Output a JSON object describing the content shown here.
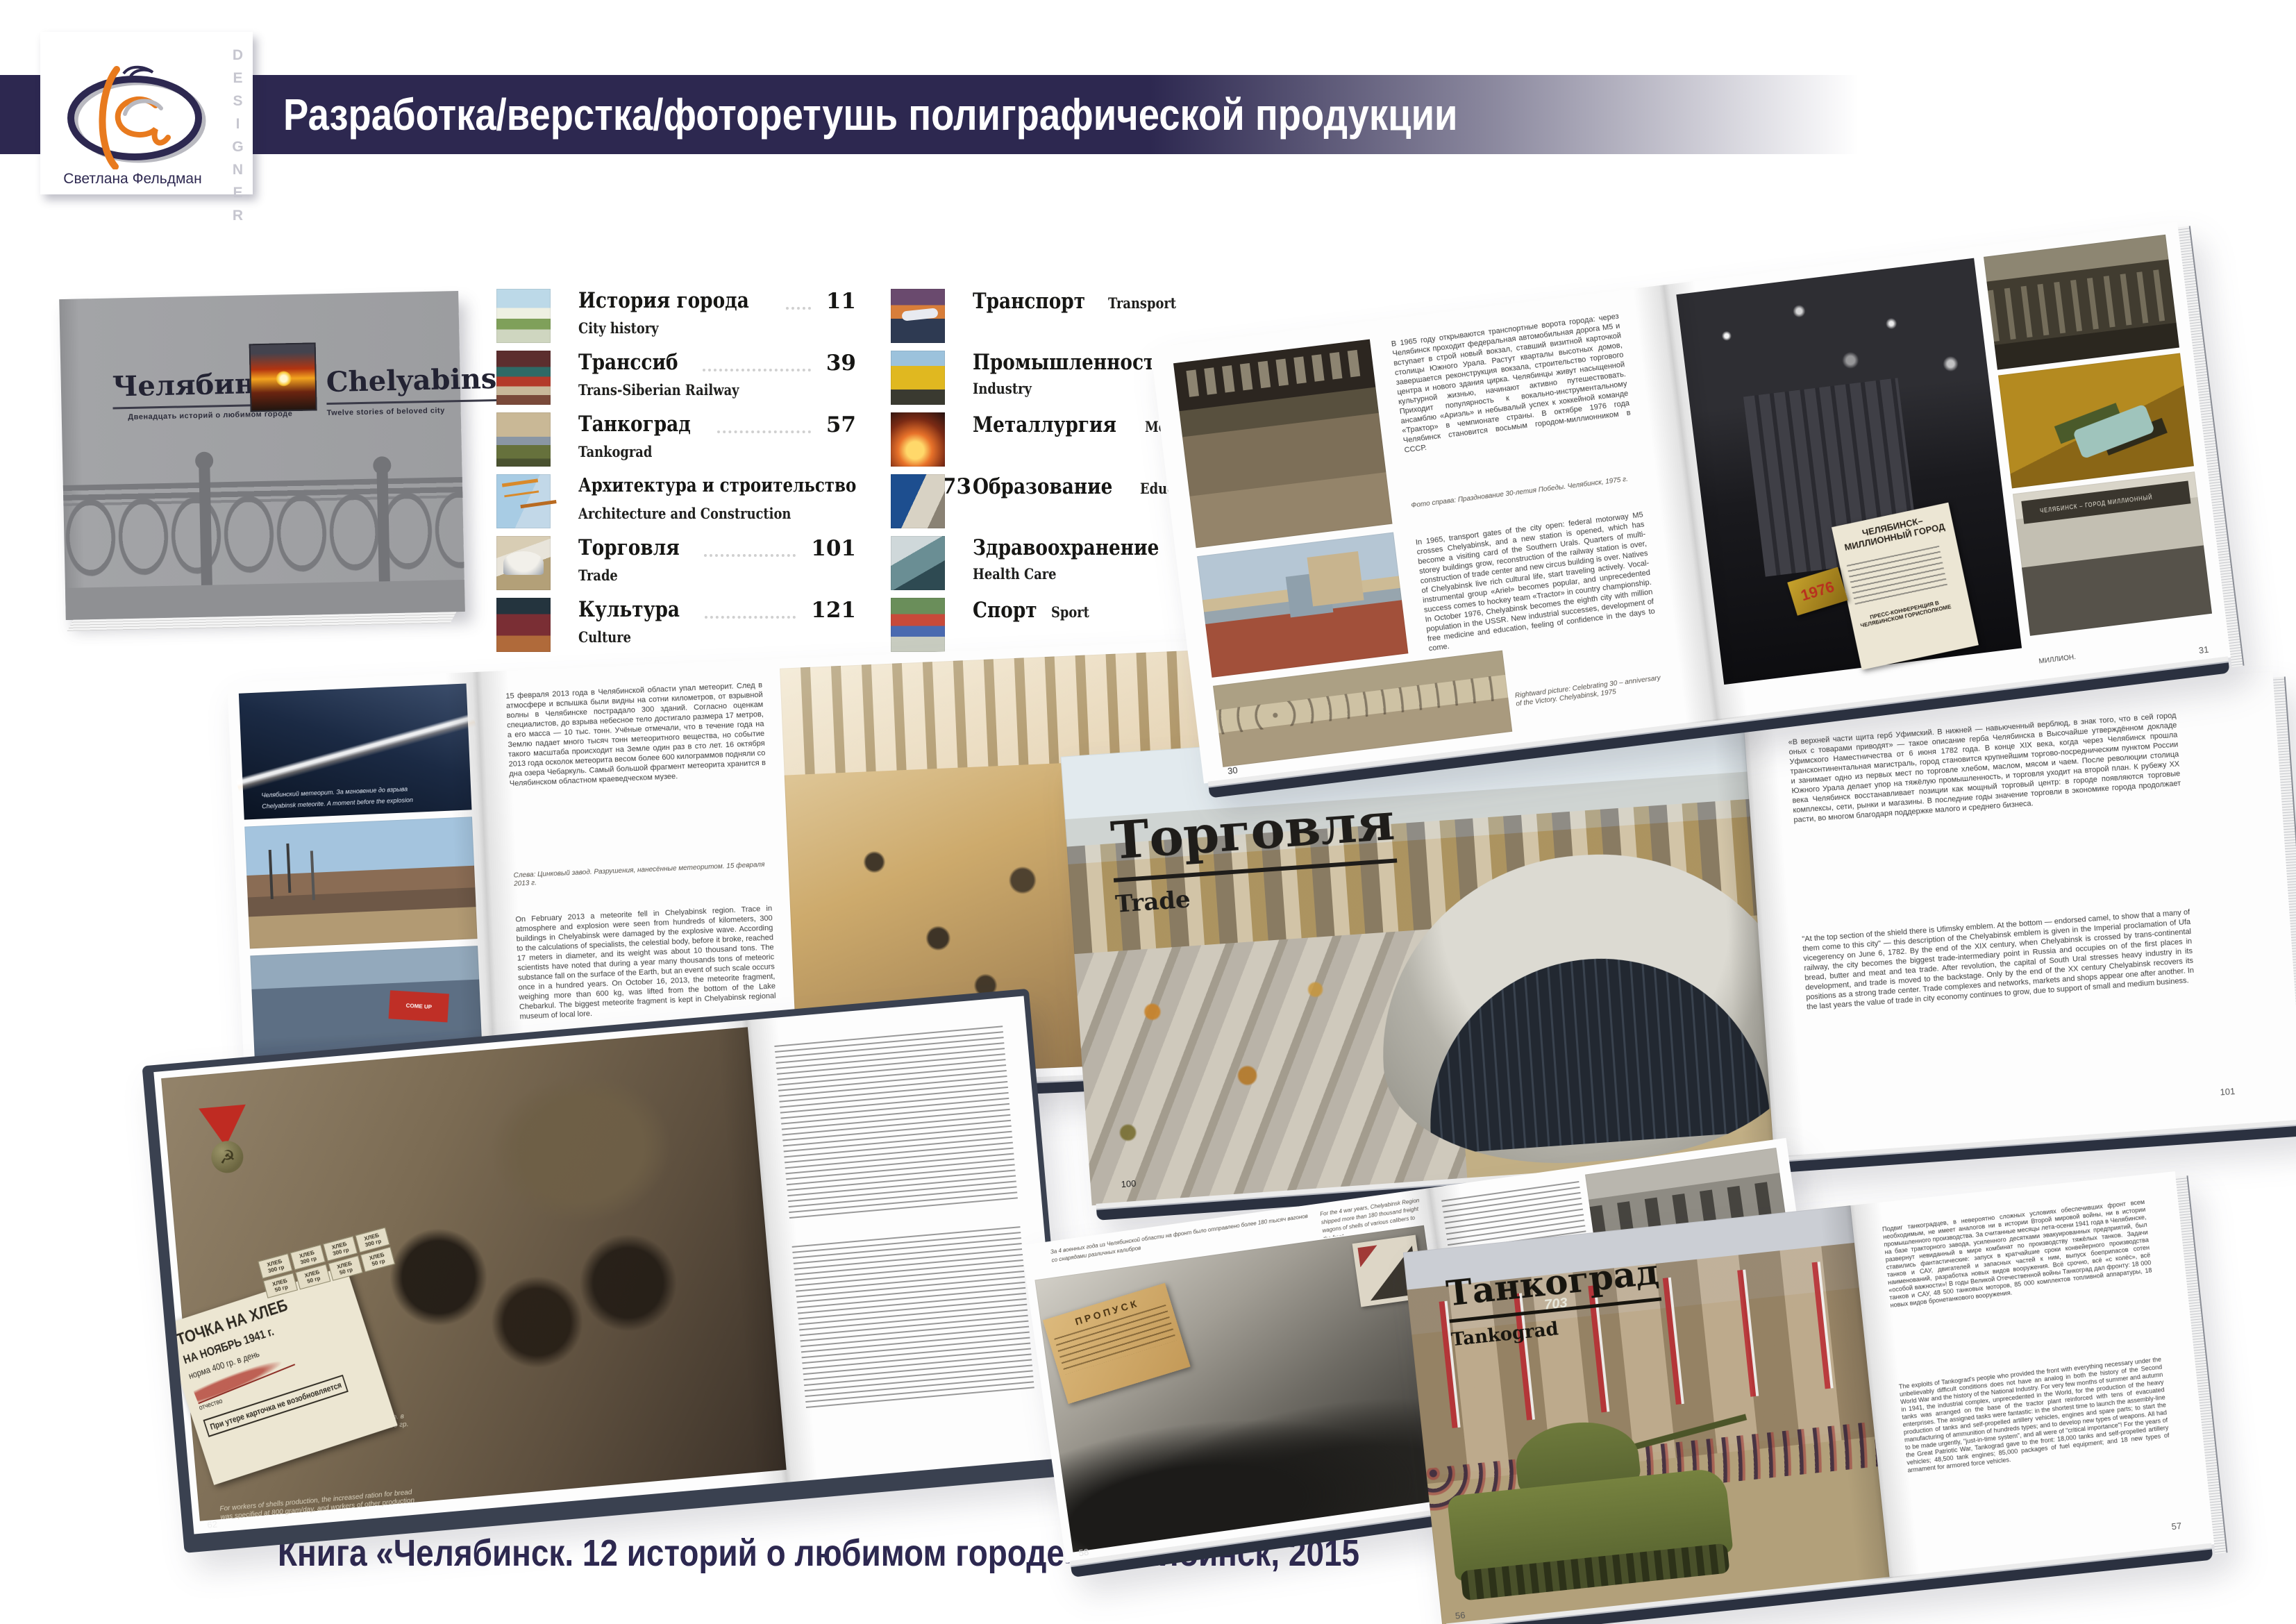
{
  "colors": {
    "navy": "#2d2850",
    "orange": "#e87a1e",
    "cover_gray": "#9c9da0"
  },
  "logo": {
    "designer": "DESIGNER",
    "name": "Светлана Фельдман"
  },
  "header": {
    "title": "Разработка/верстка/фоторетушь полиграфической продукции"
  },
  "footer": {
    "caption": "Книга «Челябинск. 12 историй о любимом городе». Челябинск, 2015"
  },
  "cover": {
    "title_ru": "Челябинск",
    "subtitle_ru": "Двенадцать историй о любимом городе",
    "title_en": "Chelyabinsk",
    "subtitle_en": "Twelve stories of beloved city"
  },
  "toc": {
    "left": [
      {
        "title": "История города",
        "subtitle": "City history",
        "page": "11"
      },
      {
        "title": "Транссиб",
        "subtitle": "Trans-Siberian Railway",
        "page": "39"
      },
      {
        "title": "Танкоград",
        "subtitle": "Tankograd",
        "page": "57"
      },
      {
        "title": "Архитектура и строительство",
        "subtitle": "Architecture and Construction",
        "page": "73"
      },
      {
        "title": "Торговля",
        "subtitle": "Trade",
        "page": "101"
      },
      {
        "title": "Культура",
        "subtitle": "Culture",
        "page": "121"
      }
    ],
    "right": [
      {
        "title": "Транспорт",
        "subtitle": "Transport"
      },
      {
        "title": "Промышленность",
        "subtitle": "Industry"
      },
      {
        "title": "Металлургия",
        "subtitle": "Metallurgy"
      },
      {
        "title": "Образование",
        "subtitle": "Education"
      },
      {
        "title": "Здравоохранение",
        "subtitle": "Health Care"
      },
      {
        "title": "Спорт",
        "subtitle": "Sport"
      }
    ]
  },
  "spread_city": {
    "page_left_number": "30",
    "page_right_number": "31",
    "text_ru": "В 1965 году открываются транспортные ворота города: через Челябинск проходит федеральная автомобильная дорога М5 и вступает в строй новый вокзал, ставший визитной карточкой столицы Южного Урала. Растут кварталы высотных домов, завершается реконструкция вокзала, строительство торгового центра и нового здания цирка. Челябинцы живут насыщенной культурной жизнью, начинают активно путешествовать. Приходит популярность к вокально-инструментальному ансамблю «Ариэль» и небывалый успех к хоккейной команде «Трактор» в чемпионате страны. В октябре 1976 года Челябинск становится восьмым городом-миллионником в СССР.",
    "caption_ru": "Фото справа: Празднование 30-летия Победы. Челябинск, 1975 г.",
    "text_en": "In 1965, transport gates of the city open: federal motorway M5 crosses Chelyabinsk, and a new station is opened, which has become a visiting card of the Southern Urals. Quarters of multi-storey buildings grow, reconstruction of the railway station is over, construction of trade center and new circus building is over. Natives of Chelyabinsk live rich cultural life, start traveling actively. Vocal-instrumental group «Ariel» becomes popular, and unprecedented success comes to hockey team «Tractor» in country championship. In October 1976, Chelyabinsk becomes the eighth city with million population in the USSR. New industrial successes, development of free medicine and education, feeling of confidence in the days to come.",
    "caption_en": "Rightward picture: Celebrating 30 – anniversary of the Victory. Chelyabinsk, 1975",
    "clipping_title": "ЧЕЛЯБИНСК– МИЛЛИОННЫЙ ГОРОД",
    "clipping_sub": "ПРЕСС-КОНФЕРЕНЦИЯ В ЧЕЛЯБИНСКОМ ГОРИСПОЛКОМЕ",
    "badge_year": "1976",
    "storefront_sign": "ЧЕЛЯБИНСК – ГОРОД МИЛЛИОННЫЙ",
    "million_label": "МИЛЛИОН."
  },
  "spread_meteorite": {
    "page_left_number": "34",
    "photo_caption_ru": "Челябинский метеорит. За мгновение до взрыва",
    "photo_caption_en": "Chelyabinsk meteorite. A moment before the explosion",
    "text_ru": "15 февраля 2013 года в Челябинской области упал метеорит. След в атмосфере и вспышка были видны на сотни километров, от взрывной волны в Челябинске пострадало 300 зданий. Согласно оценкам специалистов, до взрыва небесное тело достигало размера 17 метров, а его масса — 10 тыс. тонн. Учёные отмечали, что в течение года на Землю падает много тысяч тонн метеоритного вещества, но событие такого масштаба происходит на Земле один раз в сто лет. 16 октября 2013 года осколок метеорита весом более 600 килограммов подняли со дна озера Чебаркуль. Самый большой фрагмент метеорита хранится в Челябинском областном краеведческом музее.",
    "caption_ru": "Слева: Цинковый завод. Разрушения, нанесённые метеоритом. 15 февраля 2013 г.",
    "text_en": "On February 2013 a meteorite fell in Chelyabinsk region. Trace in atmosphere and explosion were seen from hundreds of kilometers, 300 buildings in Chelyabinsk were damaged by the explosive wave. According to the calculations of specialists, the celestial body, before it broke, reached 17 meters in diameter, and its weight was about 10 thousand tons. The scientists have noted that during a year many thousands tons of meteoric substance fall on the surface of the Earth, but an event of such scale occurs once in a hundred years. On October 16, 2013, the meteorite fragment, weighing more than 600 kg, was lifted from the bottom of the Lake Chebarkul. The biggest meteorite fragment is kept in Chelyabinsk regional museum of local lore.",
    "caption_en": "Leftward: the Zinc plant. The destruction caused by the meteorite. February 15, 2013",
    "flag_label": "COME UP"
  },
  "spread_trade": {
    "title_ru": "Торговля",
    "title_en": "Trade",
    "page_left_number": "100",
    "page_right_number": "101",
    "text_ru": "«В верхней части щита герб Уфимский. В нижней — навьюченный верблюд, в знак того, что в сей город оных с товарами приводят» — такое описание герба Челябинска в Высочайше утверждённом докладе Уфимского Наместничества от 6 июня 1782 года. В конце XIX века, когда через Челябинск прошла трансконтинентальная магистраль, город становится крупнейшим торгово-посредническим пунктом России и занимает одно из первых мест по торговле хлебом, маслом, мясом и чаем. После революции столица Южного Урала делает упор на тяжёлую промышленность, и торговля уходит на второй план. К рубежу XX века Челябинск восстанавливает позиции как мощный торговый центр: в городе появляются торговые комплексы, сети, рынки и магазины. В последние годы значение торговли в экономике города продолжает расти, во многом благодаря поддержке малого и среднего бизнеса.",
    "text_en": "\"At the top section of the shield there is Ufimsky emblem. At the bottom — endorsed camel, to show that a many of them come to this city\" — this description of the Chelyabinsk emblem is given in the Imperial proclamation of Ufa vicegerency on June 6, 1782. By the end of the XIX century, when Chelyabinsk is crossed by trans-continental railway, the city becomes the biggest trade-intermediary point in Russia and occupies on of the first places in bread, butter and meat and tea trade. After revolution, the capital of South Ural stresses heavy industry in its development, and trade is moved to the backstage. Only by the end of the XX century Chelyabinsk recovers its positions as a strong trade center. Trade complexes and networks, markets and shops appear one after another. In the last years the value of trade in city economy continues to grow, due to support of small and medium business."
  },
  "spread_workers": {
    "page_left_number": "62",
    "card_line1": "ТОЧКА НА ХЛЕБ",
    "card_line2": "НА НОЯБРЬ 1941 г.",
    "card_line3": "норма 400 гр. в день",
    "card_field": "отчество",
    "card_note": "При утере карточка не возобновляется",
    "stamp_label": "ХЛЕБ",
    "stamp_value": "300 гр",
    "stamp_value2": "50 гр",
    "caption_ru": "Для работников оборонной промышленности были обозначены повышенные нормы выдачи хлеба — 800 гр. в сутки, рабочие других предприятий получали лишь 400 гр.",
    "caption_en": "For workers of shells production, the increased ration for bread was specified at 800 gram/day, and workers of other production received only 400 gram/day."
  },
  "spread_lathe": {
    "page_left_number": "58",
    "caption_ru": "За 4 военных года из Челябинской области на фронт было отправлено более 180 тысяч вагонов со снарядами различных калибров",
    "caption_en": "For the 4 war years, Chelyabinsk Region shipped more than 180 thousand freight wagons of shells of various calibers to the front",
    "pass_title": "ПРОПУСК",
    "text_en": "The unprecedented large-scale evacuation of enterprises and human resources began in July 1941. The first special trains went to Chelyabinsk from Leningrad. People were accommodated in the very tight living conditions. The wartime regulations provided 4 sq. m per a person in the end of 1941 and 1.2 sq. m per a person in 1944. The acute shortage of equipment complicated works for the arrangement of the plants. Women and teenagers dragged the machines by using the straps at 40 degrees of frost. The absolutely unthinkable premises were adapted for newly arrived plants: the ammunition production was placed in the buildings of the Pedagogic and Agriculture institutes and even in the City's prison. In the subhuman conditions, in the unheated shops, for 12 hours a day, without day-offs, the Tankograd's people made three production tasks per shift. In December 1941, Tankograd became the Capital of the Soviet tank-building."
  },
  "spread_tankograd": {
    "title_ru": "Танкоград",
    "title_en": "Tankograd",
    "page_left_number": "56",
    "page_right_number": "57",
    "tank_number": "703",
    "text_ru": "Подвиг танкоградцев, в невероятно сложных условиях обеспечивших фронт всем необходимым, не имеет аналогов ни в истории Второй мировой войны, ни в истории промышленного производства. За считанные месяцы лета-осени 1941 года в Челябинске, на базе тракторного завода, усиленного десятками эвакуированных предприятий, был развернут невиданный в мире комбинат по производству тяжёлых танков. Задачи ставились фантастические: запуск в кратчайшие сроки конвейерного производства танков и САУ, двигателей и запасных частей к ним, выпуск боеприпасов сотен наименований, разработка новых видов вооружения. Всё срочно, всё «с колёс», всё «особой важности»! В годы Великой Отечественной войны Танкоград дал фронту: 18 000 танков и САУ, 48 500 танковых моторов, 85 000 комплектов топливной аппаратуры, 18 новых видов бронетанкового вооружения.",
    "text_en": "The exploits of Tankograd's people who provided the front with everything necessary under the unbelievably difficult conditions does not have an analog in both the history of the Second World War and the history of the National Industry. For very few months of summer and autumn in 1941, the industrial complex, unprecedented in the World, for the production of the heavy tanks was arranged on the base of the tractor plant reinforced with tens of evacuated enterprises. The assigned tasks were fantastic: in the shortest time to launch the assembly-line production of tanks and self-propelled artillery vehicles, engines and spare parts; to start the manufacturing of ammunition of hundreds types; and to develop new types of weapons. All had to be made urgently, \"just-in-time system\", and all were of \"critical importance\"! For the years of the Great Patriotic War, Tankograd gave to the front: 18,000 tanks and self-propelled artillery vehicles; 48,500 tank engines; 85,000 packages of fuel equipment; and 18 new types of armament for armored force vehicles."
  }
}
